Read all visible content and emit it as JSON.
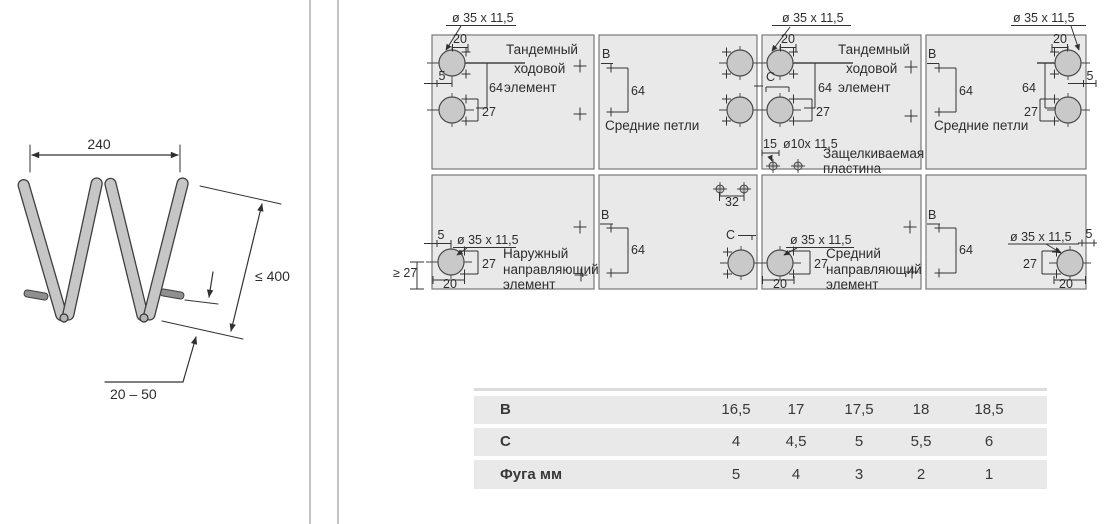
{
  "left_diagram": {
    "dim_width": "240",
    "dim_height": "≤ 400",
    "dim_gap": "20 – 50"
  },
  "dims": {
    "drill35": "ø 35 x 11,5",
    "drill10": "ø10x 11,5",
    "d5": "5",
    "d15": "15",
    "d20": "20",
    "d27": "27",
    "d32": "32",
    "d64": "64",
    "min27": "≥ 27",
    "B": "B",
    "C": "C"
  },
  "captions": {
    "tandem_line1": "Тандемный",
    "tandem_line2": "ходовой",
    "tandem_line3": "элемент",
    "middle_hinges": "Средние петли",
    "snap_line1": "Защелкиваемая",
    "snap_line2": "пластина",
    "outer_line1": "Наружный",
    "outer_line2": "направляющий",
    "outer_line3": "элемент",
    "mid_guide_line1": "Средний",
    "mid_guide_line2": "направляющий",
    "mid_guide_line3": "элемент"
  },
  "table": {
    "rows": [
      {
        "label": "B",
        "values": [
          "16,5",
          "17",
          "17,5",
          "18",
          "18,5"
        ]
      },
      {
        "label": "C",
        "values": [
          "4",
          "4,5",
          "5",
          "5,5",
          "6"
        ]
      },
      {
        "label": "Фуга мм",
        "values": [
          "5",
          "4",
          "3",
          "2",
          "1"
        ]
      }
    ]
  },
  "colors": {
    "panel_fill": "#e9e9e9",
    "cup_fill": "#c9c9c9",
    "bar_fill": "#c6c6c6",
    "line": "#333333",
    "table_band": "#e9e9e9"
  }
}
